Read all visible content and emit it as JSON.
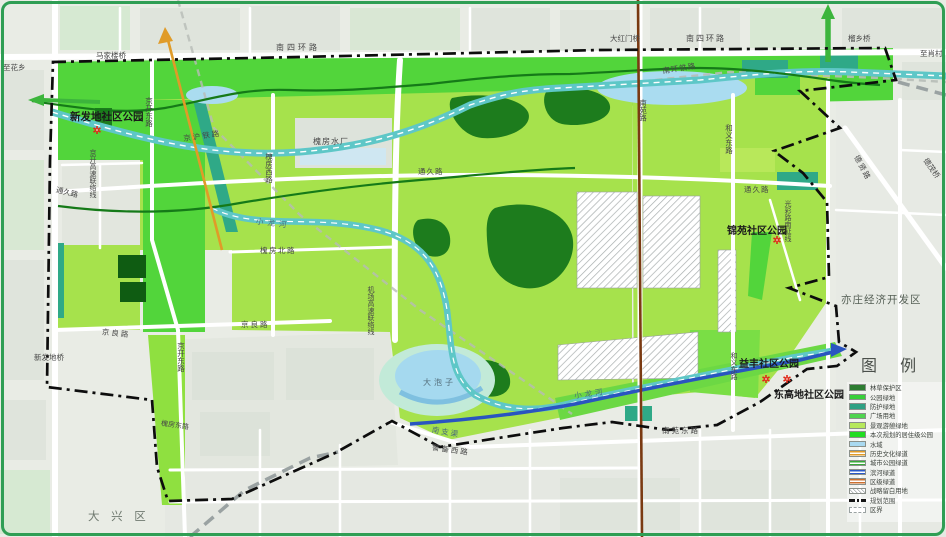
{
  "map": {
    "parks": {
      "xinfadi": "新发地社区公园",
      "jinyuan": "锦苑社区公园",
      "yifeng": "益丰社区公园",
      "donggaodi": "东高地社区公园"
    },
    "districts": {
      "daxing": "大 兴 区",
      "yizhuang": "亦庄经济开发区"
    },
    "roads": {
      "nansihuan_w": "南四环路",
      "nansihuan_e": "南四环路",
      "jingkai_donglu_n": "京开东路",
      "jingkai_donglu_s": "京开东路",
      "jingkai_lianluo": "京开高速联络线",
      "jichang_lianluo": "机场高速联络线",
      "jingliang_w": "京良路",
      "jingliang_e": "京良路",
      "huaifang_xilu": "槐房西路",
      "huaifang_beilu": "槐房北路",
      "huaifang_donglu": "槐房东路",
      "tongjiu_w": "通久路",
      "tongjiu_c": "通久路",
      "tongjiu_e": "通久路",
      "nanyuan_lu": "南苑路",
      "nanyuan_donglu": "南苑东路",
      "jingbei_xilu": "警备西路",
      "heyi_donglu_n": "和义东路",
      "heyi_donglu_s": "和义东路",
      "guangcai_nanyan": "光彩路南延线",
      "dexian_lu": "德贤路"
    },
    "bridges": {
      "majialou": "马家楼桥",
      "dahongmen": "大红门桥",
      "liuxiang": "榴乡桥",
      "xinfadi": "新发地桥",
      "demao": "德茂桥"
    },
    "railways": {
      "jinghu": "京沪铁路",
      "nanhuan": "南环铁路"
    },
    "water": {
      "dapaozi": "大泡子",
      "xiaolonghe_w": "小龙河",
      "xiaolonghe_e": "小龙河",
      "nanzhiqu": "南支渠"
    },
    "places": {
      "shuichang": "槐房水厂",
      "to_huaxiang": "至花乡",
      "to_xiaocun": "至肖村"
    }
  },
  "legend": {
    "title": "图  例",
    "items": [
      {
        "label": "林草保护区",
        "type": "fill",
        "color": "#2e7d32"
      },
      {
        "label": "公园绿地",
        "type": "fill",
        "color": "#38cf3a"
      },
      {
        "label": "防护绿地",
        "type": "fill",
        "color": "#2fa183"
      },
      {
        "label": "广场用地",
        "type": "fill",
        "color": "#4fd44f"
      },
      {
        "label": "景观游憩绿地",
        "type": "fill",
        "color": "#b6e85c"
      },
      {
        "label": "本次规划的居住级公园",
        "type": "fill",
        "color": "#21dd21"
      },
      {
        "label": "水域",
        "type": "fill",
        "color": "#a9d9f0"
      },
      {
        "label": "历史文化绿道",
        "type": "line",
        "color": "#e09b28"
      },
      {
        "label": "城市公园绿道",
        "type": "line",
        "color": "#3aaa3a"
      },
      {
        "label": "滨河绿道",
        "type": "line",
        "color": "#2b59c8"
      },
      {
        "label": "区级绿道",
        "type": "line",
        "color": "#cc7030"
      },
      {
        "label": "战略留白用地",
        "type": "hatch",
        "color": "#9aa0a0"
      },
      {
        "label": "规划范围",
        "type": "dashdot",
        "color": "#111111"
      },
      {
        "label": "区界",
        "type": "dash",
        "color": "#9aa2a2"
      }
    ]
  },
  "colors": {
    "park_green": "#a6e24c",
    "bright_green": "#52d53b",
    "dark_green": "#1d7c1d",
    "teal_green": "#2fa987",
    "water_blue": "#a5d9ef",
    "river_teal": "#5ec7c7",
    "greenway_blue": "#2a55c0",
    "axis_brown": "#7a3a12",
    "heritage_orange": "#e09b28",
    "frame_green": "#2f9e54"
  }
}
